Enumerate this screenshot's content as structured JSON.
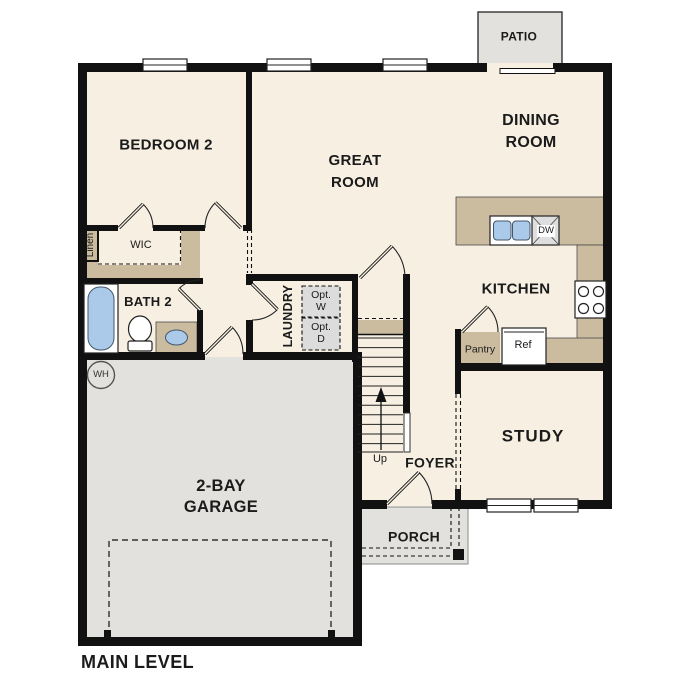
{
  "title": "MAIN LEVEL",
  "colors": {
    "floor": "#f6efe2",
    "hard_surface": "#e3e1dd",
    "counter_tan": "#cbbc9f",
    "fixture_blue": "#abc9e9",
    "wall": "#111111",
    "opt_box_gray": "#dcdcdc"
  },
  "rooms": {
    "bedroom2": "BEDROOM 2",
    "great_room": "GREAT\nROOM",
    "dining_room": "DINING\nROOM",
    "kitchen": "KITCHEN",
    "study": "STUDY",
    "foyer": "FOYER",
    "porch": "PORCH",
    "patio": "PATIO",
    "garage": "2-BAY\nGARAGE",
    "laundry": "LAUNDRY",
    "bath2": "BATH 2",
    "wic": "WIC",
    "linen": "Linen"
  },
  "fixtures": {
    "dishwasher": "DW",
    "refrigerator": "Ref",
    "pantry": "Pantry",
    "water_heater": "WH",
    "opt_washer": "Opt.\nW",
    "opt_dryer": "Opt.\nD",
    "stairs_up": "Up"
  }
}
